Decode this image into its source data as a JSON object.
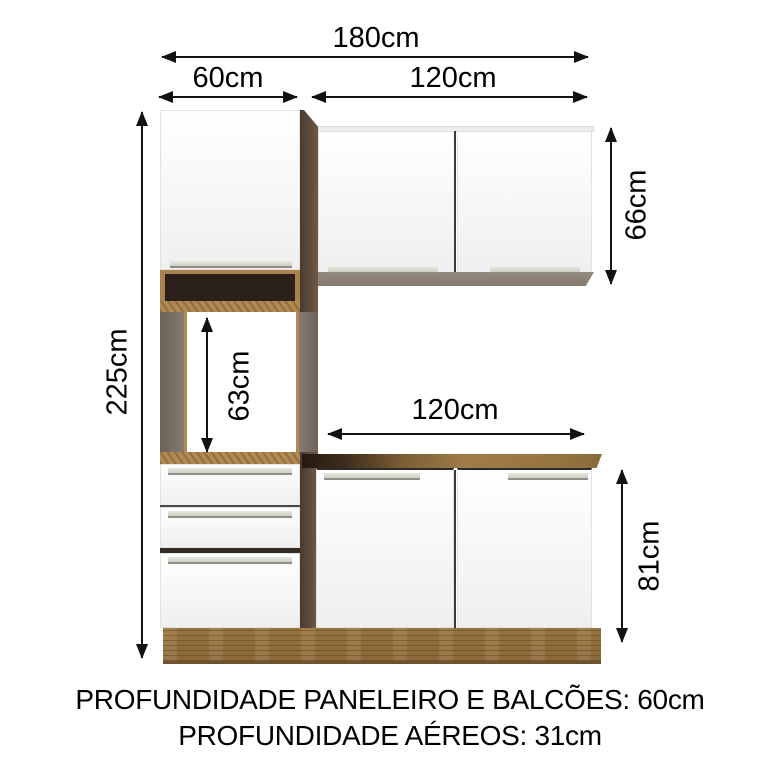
{
  "dimensions": {
    "total_width": "180cm",
    "pantry_width": "60cm",
    "upper_width": "120cm",
    "total_height": "225cm",
    "upper_height": "66cm",
    "oven_space_height": "63cm",
    "base_width": "120cm",
    "base_height": "81cm"
  },
  "footer": {
    "line1": "PROFUNDIDADE PANELEIRO E BALCÕES: 60cm",
    "line2": "PROFUNDIDADE AÉREOS: 31cm"
  },
  "colors": {
    "wood": "#96743f",
    "wood_light_edge": "#b08a52",
    "wood_dark_side": "#4e3e33",
    "niche_interior": "#2c211a",
    "frame_gray": "#786d64",
    "door_white": "#f9f9f9",
    "handle": "#d4d4ca",
    "dimension_line": "#121212"
  }
}
